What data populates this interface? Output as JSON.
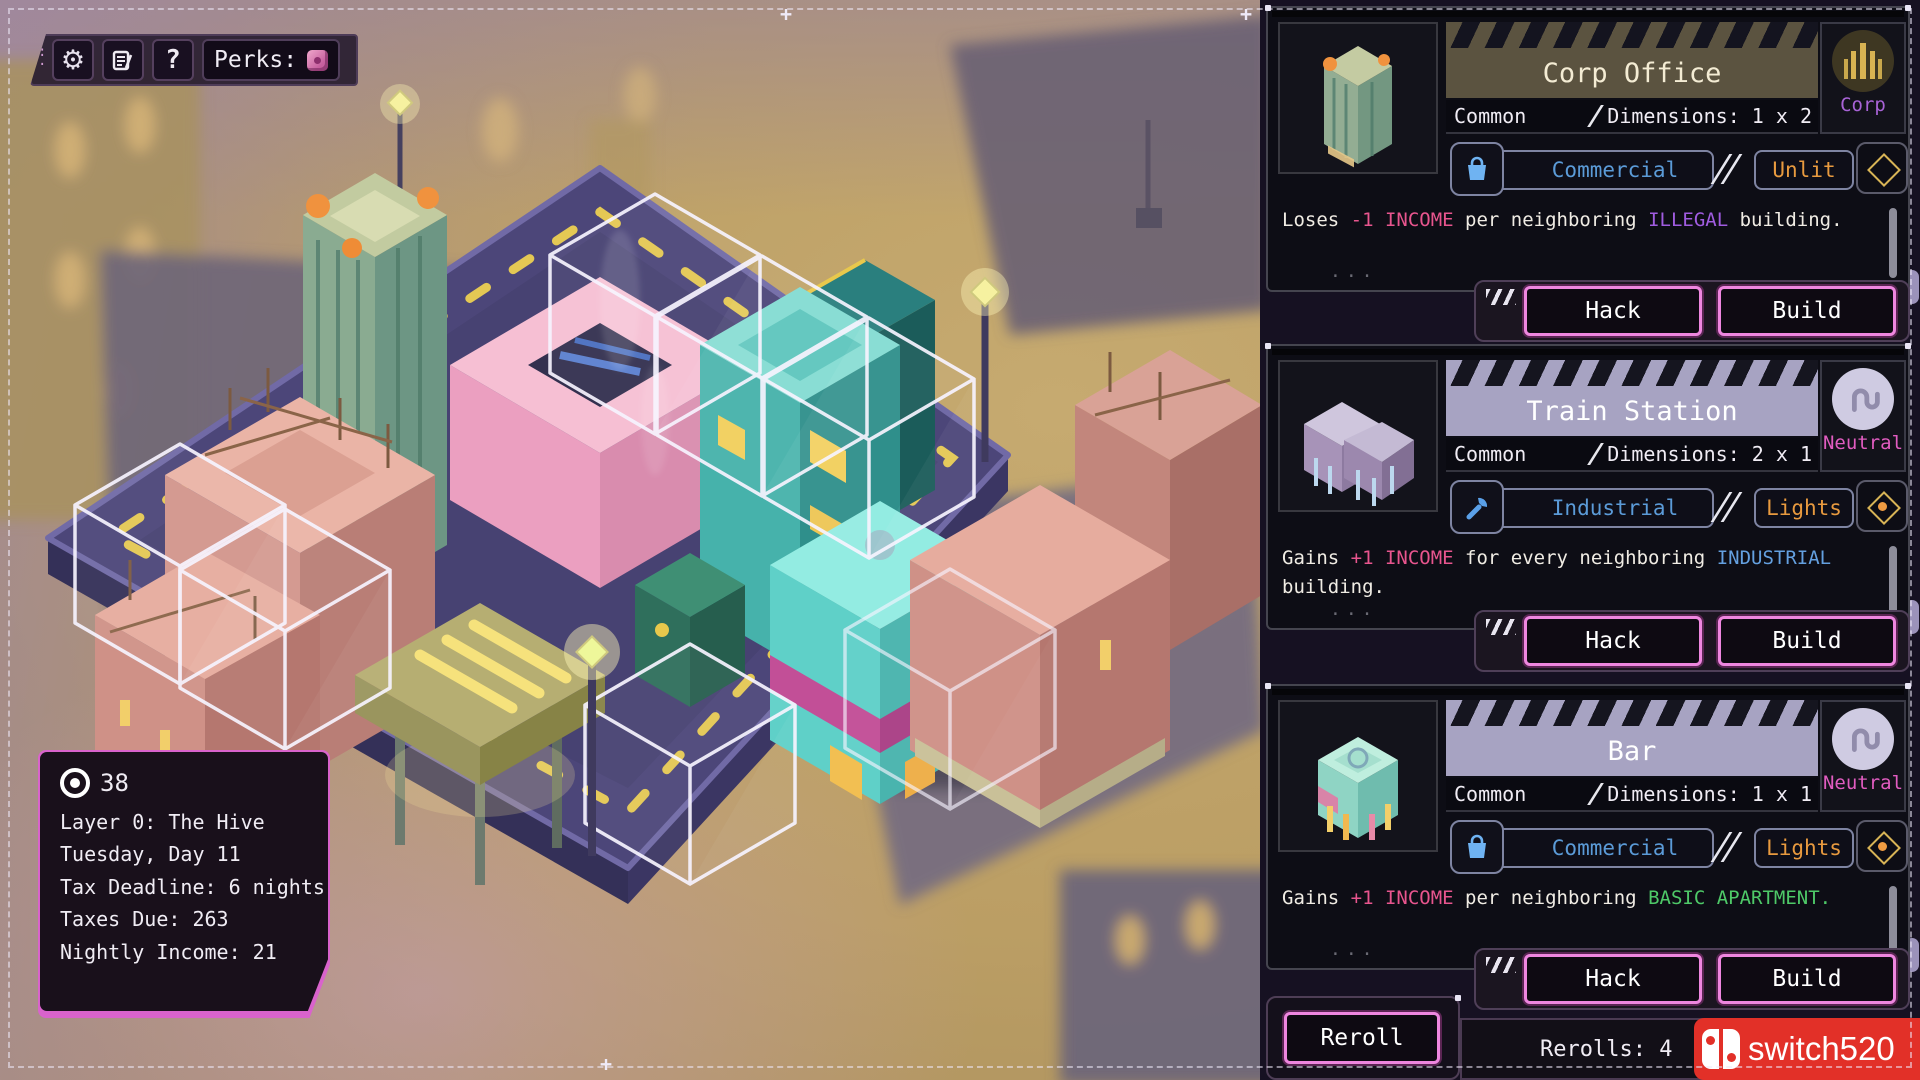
{
  "colors": {
    "accent_pink": "#ee86df",
    "dash_yellow": "#ecd052",
    "watermark_red": "#e23028",
    "income_pink": "#e8558e",
    "illegal_purple": "#a05ce0",
    "industrial_blue": "#64a0e0",
    "basic_green": "#4ec968",
    "light_orange": "#e89a3f",
    "platform_purple": "#4c4679"
  },
  "toolbar": {
    "perks_label": "Perks:",
    "icons": {
      "settings": "gear-icon",
      "news": "news-icon",
      "help": "question-icon",
      "perks": "perk-die-icon"
    }
  },
  "status_panel": {
    "money": "38",
    "layer": "Layer 0: The Hive",
    "day": "Tuesday, Day 11",
    "deadline": "Tax Deadline: 6 nights",
    "taxes": "Taxes Due: 263",
    "income": "Nightly Income: 21"
  },
  "cards": [
    {
      "title": "Corp Office",
      "rarity": "Common",
      "dimensions": "Dimensions: 1 x 2",
      "badge": {
        "label": "Corp",
        "icon": "corp-tower-icon"
      },
      "category": {
        "label": "Commercial",
        "icon": "shopping-bag-icon"
      },
      "light": {
        "label": "Unlit",
        "lit": false
      },
      "thumbnail": "corp-office-building",
      "desc": [
        {
          "text": "Loses ",
          "cls": "w"
        },
        {
          "text": "-1 INCOME",
          "cls": "pink"
        },
        {
          "text": " per neighboring ",
          "cls": "w"
        },
        {
          "text": "ILLEGAL",
          "cls": "purple"
        },
        {
          "text": " building.",
          "cls": "w"
        }
      ],
      "hack": "Hack",
      "build": "Build"
    },
    {
      "title": "Train Station",
      "rarity": "Common",
      "dimensions": "Dimensions: 2 x 1",
      "badge": {
        "label": "Neutral",
        "icon": "neutral-hook-icon"
      },
      "category": {
        "label": "Industrial",
        "icon": "wrench-icon"
      },
      "light": {
        "label": "Lights",
        "lit": true
      },
      "thumbnail": "train-station-building",
      "desc": [
        {
          "text": "Gains ",
          "cls": "w"
        },
        {
          "text": "+1 INCOME",
          "cls": "pink"
        },
        {
          "text": " for every neighboring ",
          "cls": "w"
        },
        {
          "text": "INDUSTRIAL",
          "cls": "blue"
        },
        {
          "text": " building.",
          "cls": "w"
        }
      ],
      "hack": "Hack",
      "build": "Build"
    },
    {
      "title": "Bar",
      "rarity": "Common",
      "dimensions": "Dimensions: 1 x 1",
      "badge": {
        "label": "Neutral",
        "icon": "neutral-hook-icon"
      },
      "category": {
        "label": "Commercial",
        "icon": "shopping-bag-icon"
      },
      "light": {
        "label": "Lights",
        "lit": true
      },
      "thumbnail": "bar-building",
      "desc": [
        {
          "text": "Gains ",
          "cls": "w"
        },
        {
          "text": "+1 INCOME",
          "cls": "pink"
        },
        {
          "text": " per neighboring ",
          "cls": "w"
        },
        {
          "text": "BASIC APARTMENT",
          "cls": "green"
        },
        {
          "text": ".",
          "cls": "green"
        }
      ],
      "hack": "Hack",
      "build": "Build"
    }
  ],
  "footer": {
    "reroll": "Reroll",
    "rerolls": "Rerolls: 4",
    "hand": "H"
  },
  "watermark": {
    "text": "switch520"
  }
}
